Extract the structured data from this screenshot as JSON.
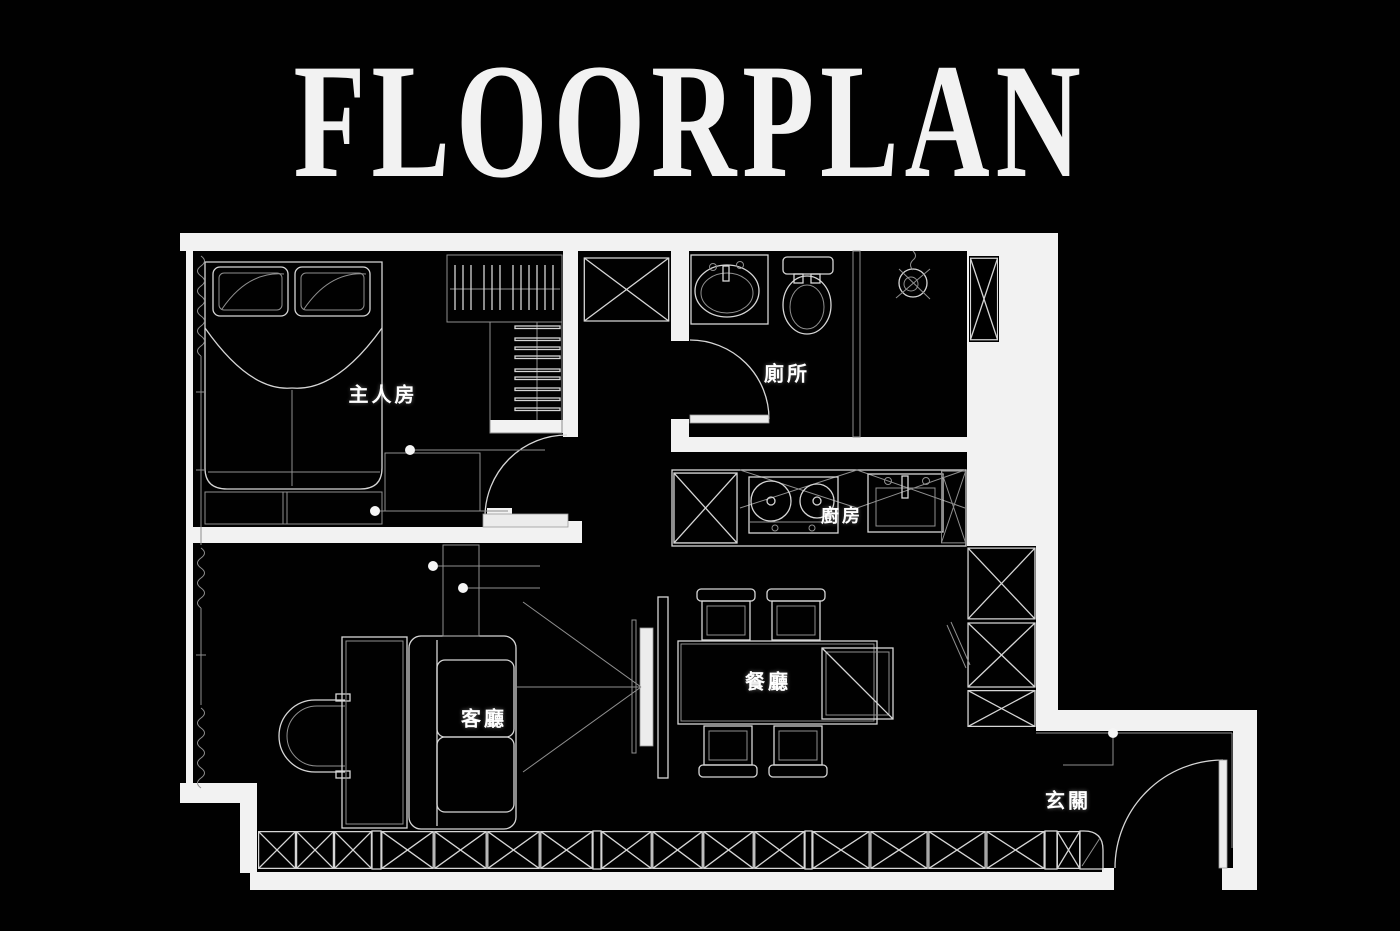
{
  "title": "FLOORPLAN",
  "colors": {
    "background": "#000000",
    "wall": "#f2f2f2",
    "line_bright": "#d6d6d6",
    "line_dim": "#8f8f8f",
    "label_text": "#ffffff"
  },
  "rooms": [
    {
      "id": "master-bedroom",
      "label": "主人房"
    },
    {
      "id": "toilet",
      "label": "廁所"
    },
    {
      "id": "kitchen",
      "label": "廚房"
    },
    {
      "id": "dining-room",
      "label": "餐廳"
    },
    {
      "id": "living-room",
      "label": "客廳"
    },
    {
      "id": "entrance",
      "label": "玄關"
    }
  ]
}
